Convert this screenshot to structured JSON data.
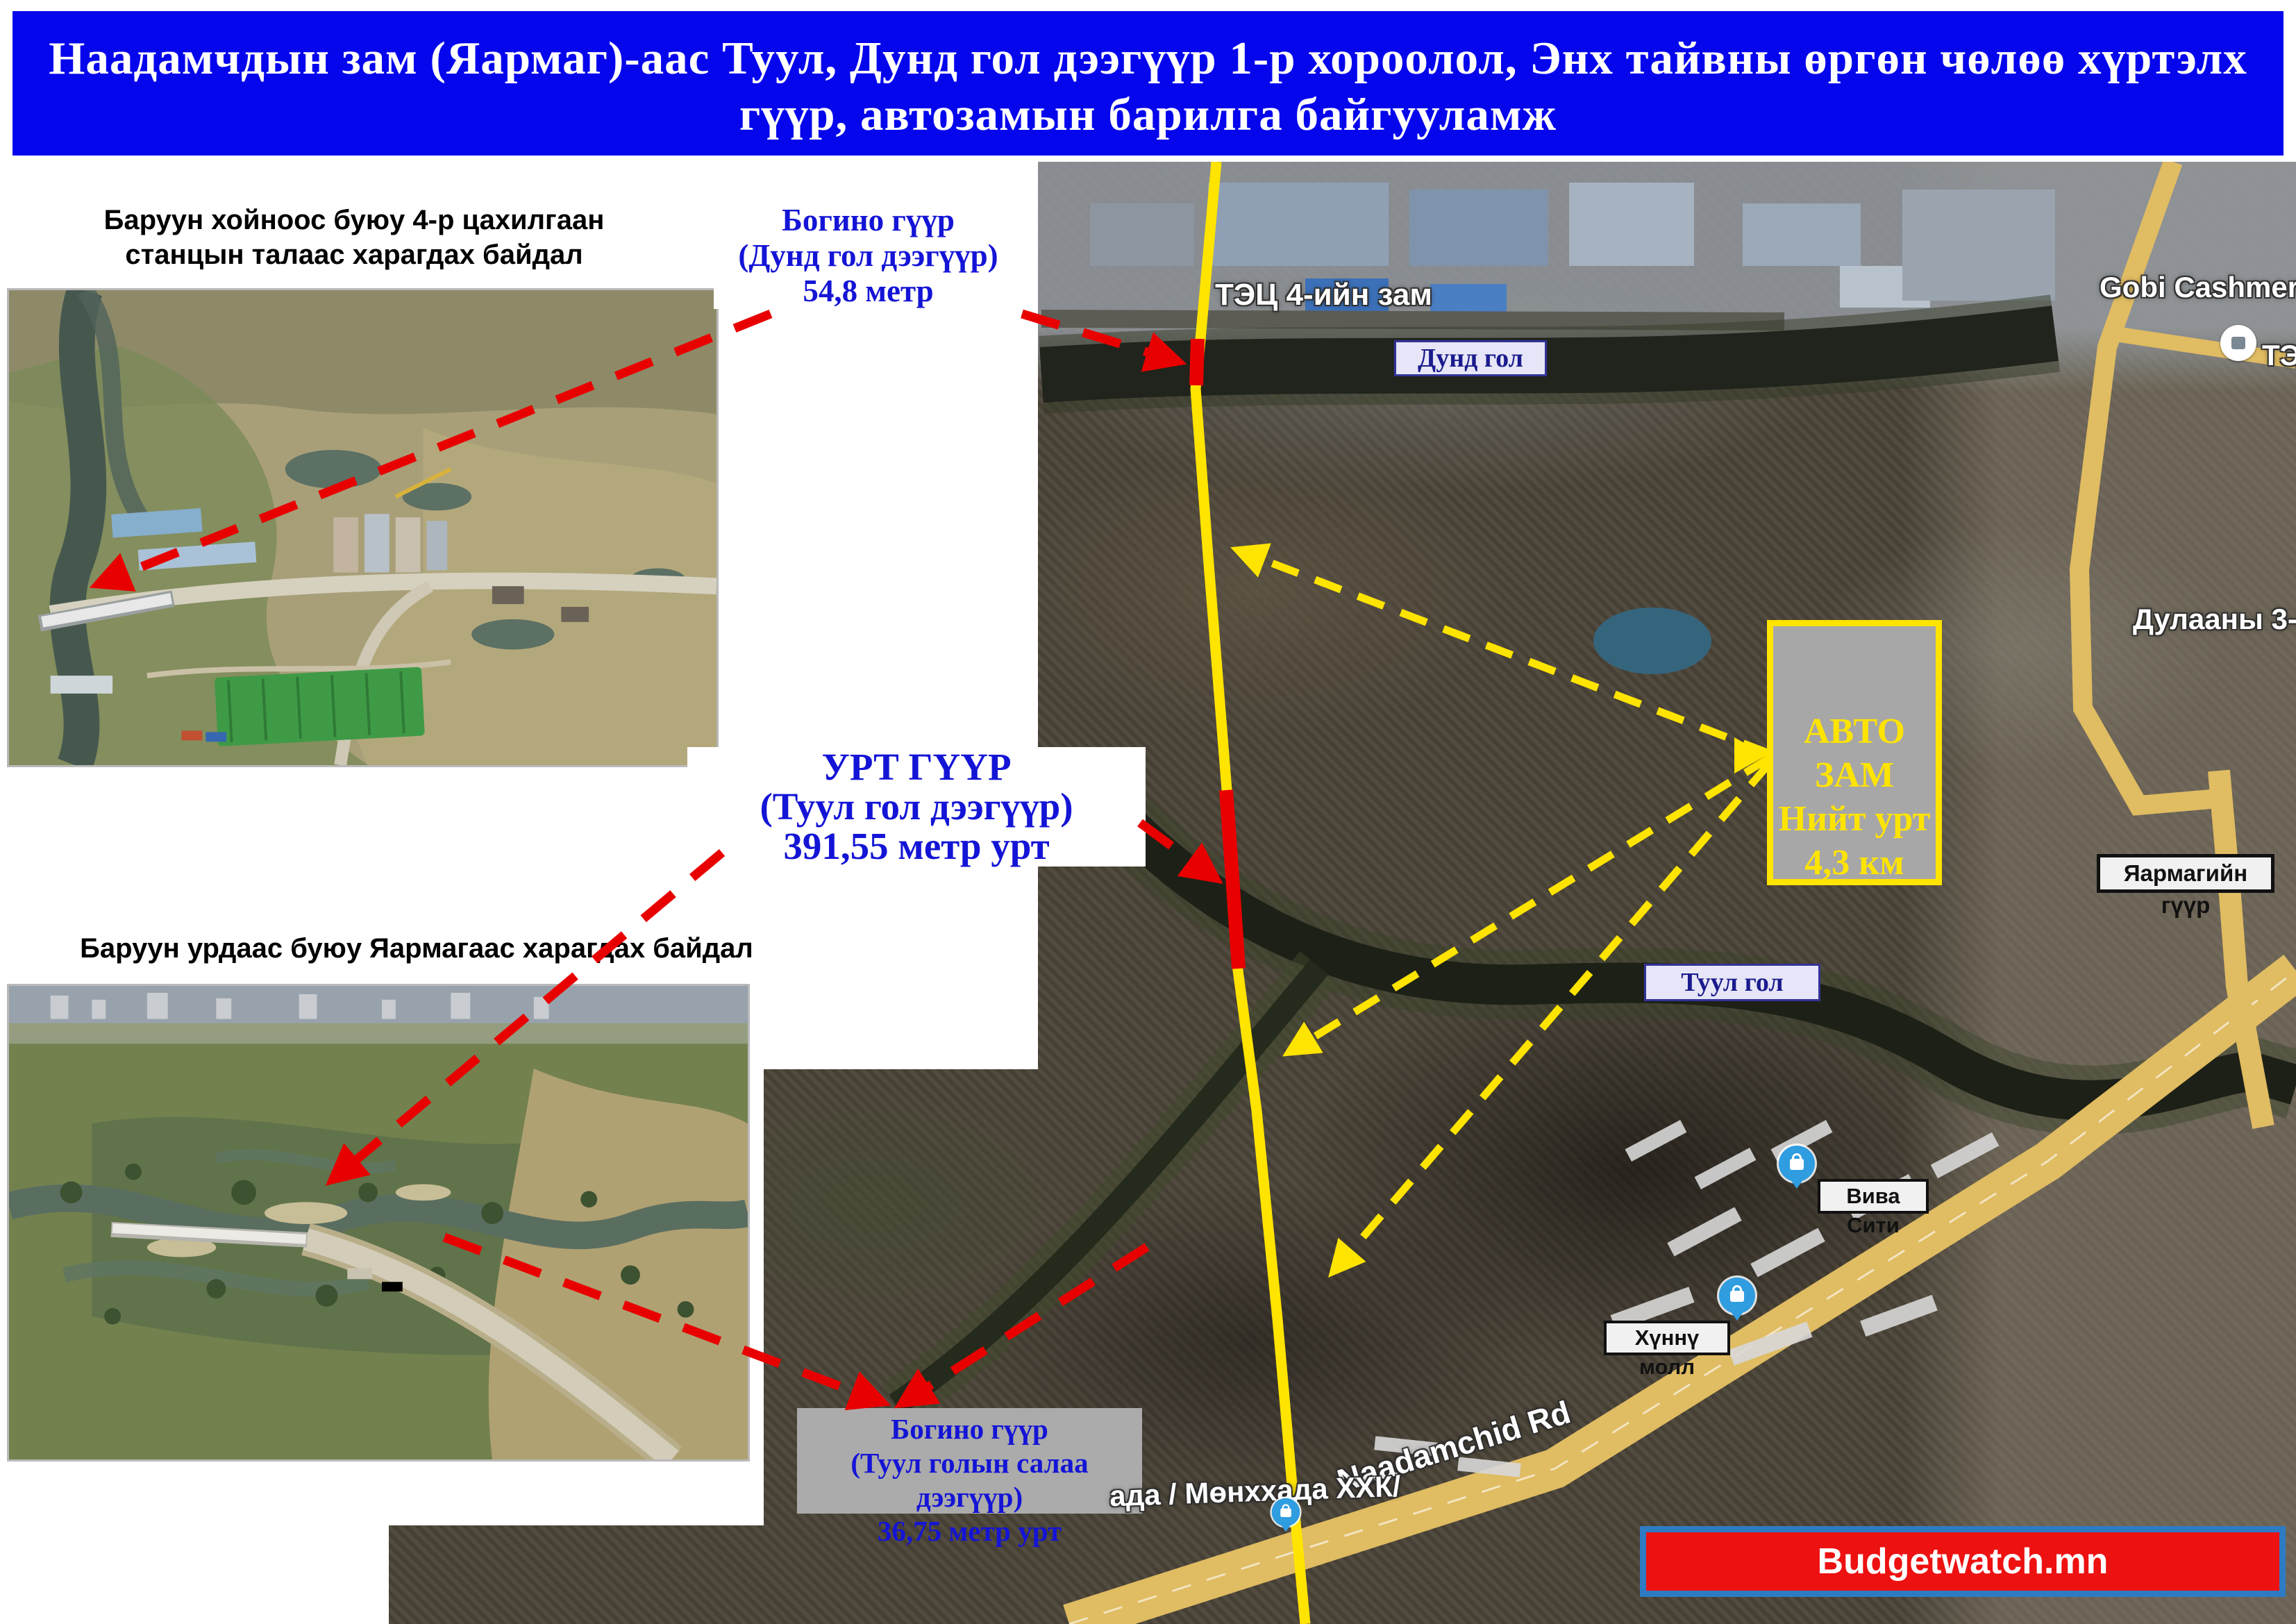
{
  "title": {
    "line1": "Наадамчдын зам (Яармаг)-аас  Туул, Дунд гол дээгүүр 1-р хороолол, Энх тайвны өргөн чөлөө хүртэлх",
    "line2": "гүүр, автозамын барилга байгууламж"
  },
  "photos": {
    "photo1_caption": "Баруун хойноос буюу 4-р цахилгаан станцын талаас харагдах байдал",
    "photo2_caption": "Баруун урдаас буюу Яармагаас харагдах байдал"
  },
  "callouts": {
    "short_bridge_dund": {
      "line1": "Богино гүүр",
      "line2": "(Дунд гол дээгүүр)",
      "line3": "54,8 метр"
    },
    "long_bridge": {
      "line1": "УРТ ГҮҮР",
      "line2": "(Туул гол дээгүүр)",
      "line3": "391,55 метр урт"
    },
    "short_bridge_salaa": {
      "line1": "Богино гүүр",
      "line2": "(Туул голын салаа дээгүүр)",
      "line3": "36,75 метр  урт"
    },
    "auto_road": {
      "line1": "АВТО",
      "line2": "ЗАМ",
      "line3": "Нийт урт",
      "line4": "4,3 км"
    }
  },
  "map": {
    "labels": {
      "dund_gol": "Дунд гол",
      "tuul_gol": "Туул гол",
      "yarmag_bridge": "Яармагийн гүүр",
      "viva_city": "Вива Сити",
      "hunnu_mall": "Хүннү молл",
      "tets4_road": "ТЭЦ 4-ийн зам",
      "gobi_cashmere": "Gobi Cashmere Fac",
      "dulaany": "Дулааны 3-р Ц",
      "naadamchid_rd": "Naadamchid Rd",
      "munkhhada": "ада / Мөнххада ХХК/",
      "te_partial": "ТЭ"
    }
  },
  "footer": {
    "brand": "Budgetwatch.mn"
  },
  "colors": {
    "banner_bg": "#0606ec",
    "callout_blue": "#1414d6",
    "planned_road_yellow": "#ffe400",
    "bridge_red": "#ee0000",
    "footer_bg": "#ed1111",
    "footer_border": "#2e7bc4",
    "box_gray": "#a7a7a7",
    "river_label_bg": "#e6e6f8"
  }
}
